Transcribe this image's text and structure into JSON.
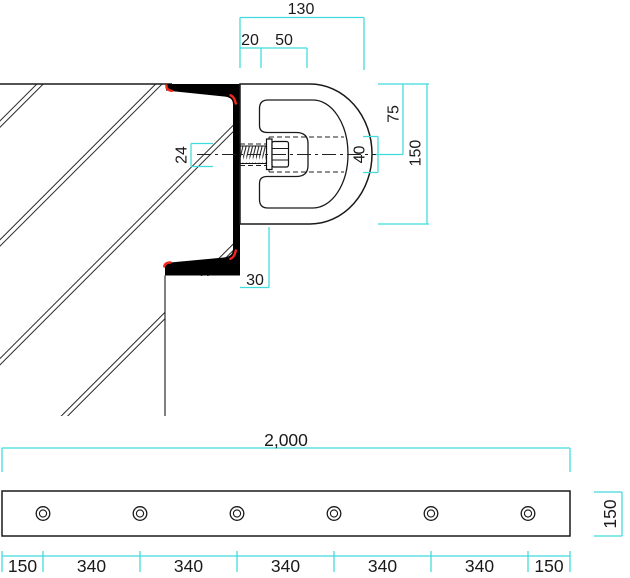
{
  "detail": {
    "dim_width_overall": "130",
    "dim_wall": "20",
    "dim_cavity": "50",
    "dim_bolt": "24",
    "dim_hole": "40",
    "dim_half_height": "75",
    "dim_height": "150",
    "dim_flange": "30"
  },
  "plate": {
    "dim_length": "2,000",
    "dim_height": "150",
    "spacings": [
      "150",
      "340",
      "340",
      "340",
      "340",
      "340",
      "150"
    ],
    "hole_count": "6"
  },
  "colors": {
    "dimension_cyan": "#3fdbde",
    "weld_red": "#f2281c",
    "line_black": "#1a1a1a"
  }
}
